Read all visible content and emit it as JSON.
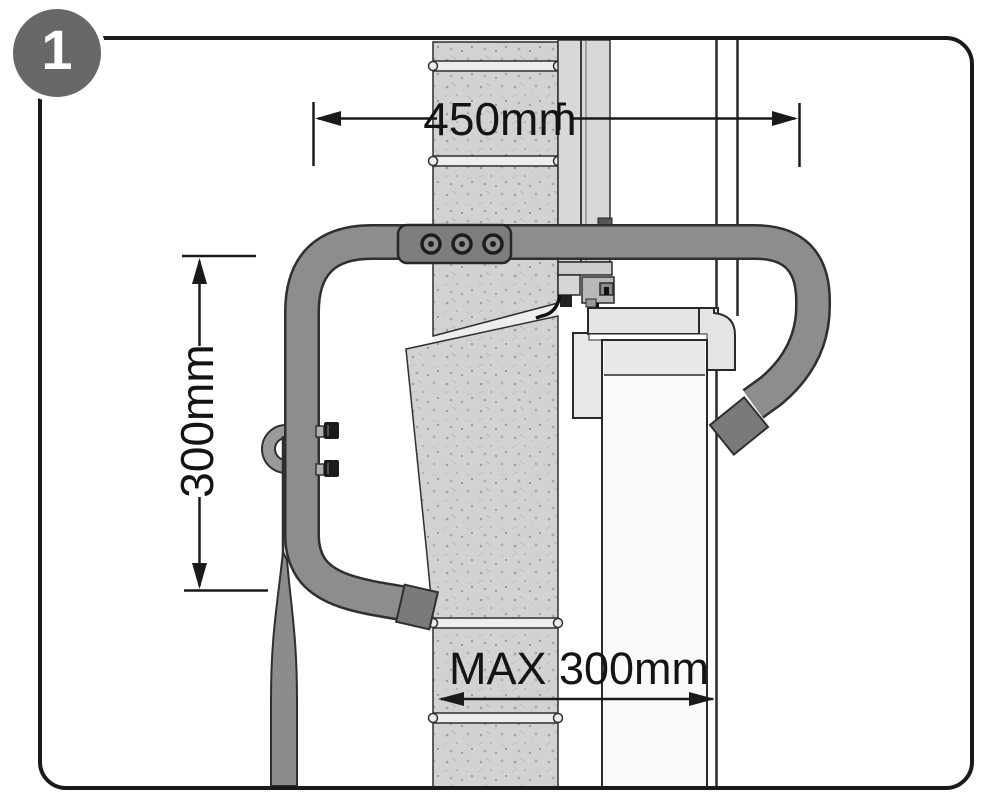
{
  "figure": {
    "step_number": "1",
    "dimensions": {
      "top_width": "450mm",
      "left_height": "300mm",
      "bottom_max": "MAX 300mm"
    },
    "colors": {
      "line": "#1a1a1a",
      "tube_gray": "#8d8d8d",
      "tube_cap_gray": "#7a7a7a",
      "plate_gray": "#7d7d7d",
      "brick_gray": "#d2d2d2",
      "frame_gray": "#d8d8d8",
      "panel_gray": "#e6e6e6",
      "badge_gray": "#686868",
      "background": "#ffffff"
    }
  }
}
